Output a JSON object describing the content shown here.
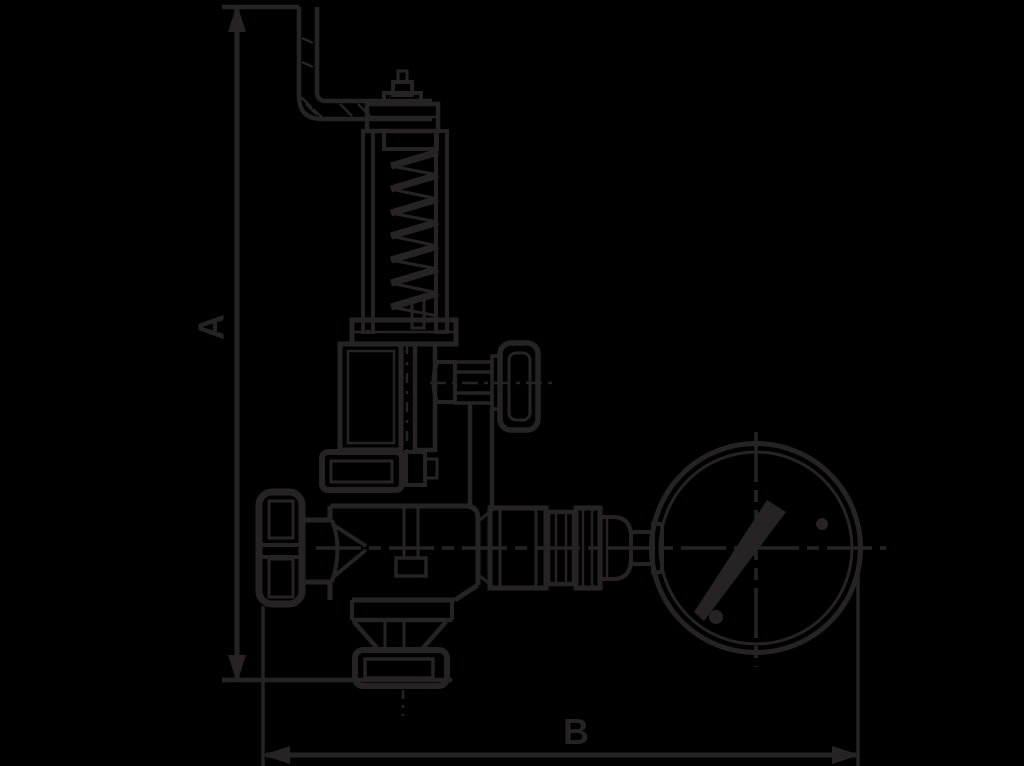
{
  "page": {
    "background_color": "#000000",
    "ink_color": "#272324"
  },
  "drawing": {
    "kind": "valve-with-pressure-gauge-dimension-drawing",
    "labels": {
      "dimension_vertical": "A",
      "dimension_horizontal": "B"
    }
  }
}
